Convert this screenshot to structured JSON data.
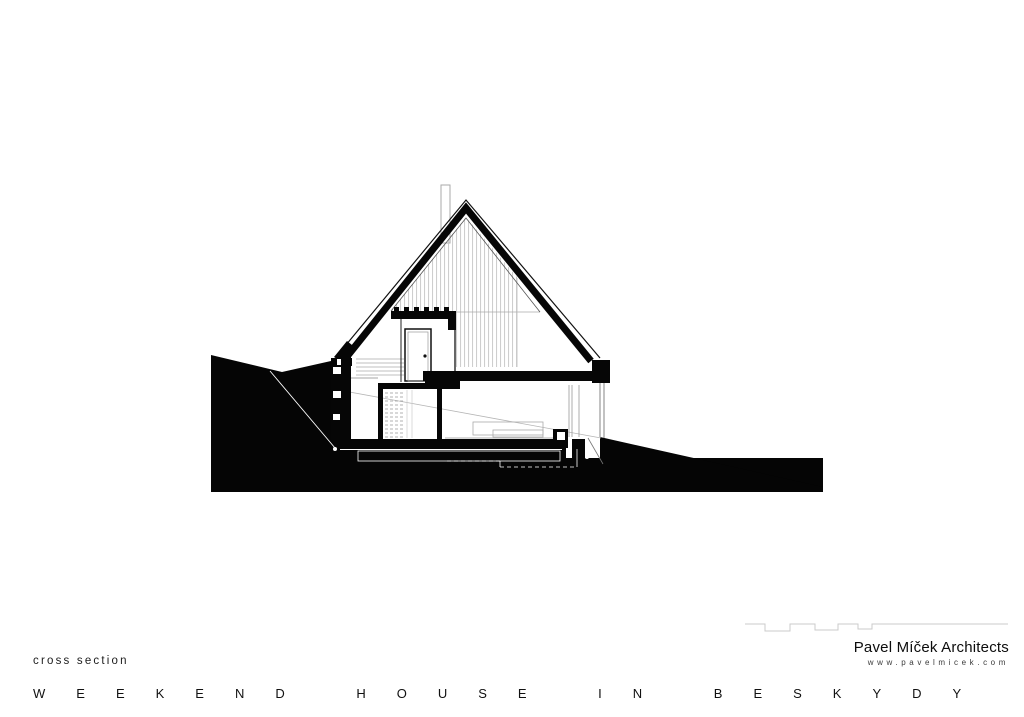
{
  "sheet": {
    "caption": "cross section",
    "title": "WEEKEND HOUSE IN BESKYDY",
    "architect": {
      "name": "Pavel Míček Architects",
      "website": "www.pavelmicek.com"
    },
    "colors": {
      "paper": "#ffffff",
      "ink": "#060606",
      "terrain_fill": "#050505",
      "hatch_line": "#c5c5c5",
      "faint_line": "#aaaaaa",
      "logo_line": "#cbcbcb",
      "marker": "#ffffff"
    },
    "drawing": {
      "kind": "architectural section",
      "elements": [
        "gable-roof",
        "roof-chimney",
        "attic-hatch-wall",
        "attic-floor-beam",
        "interior-door",
        "staircase",
        "floor-slab",
        "bottom-slab",
        "left-retaining-wall",
        "right-glazing",
        "terrain-cut",
        "foundation-outline",
        "survey-markers"
      ]
    }
  }
}
